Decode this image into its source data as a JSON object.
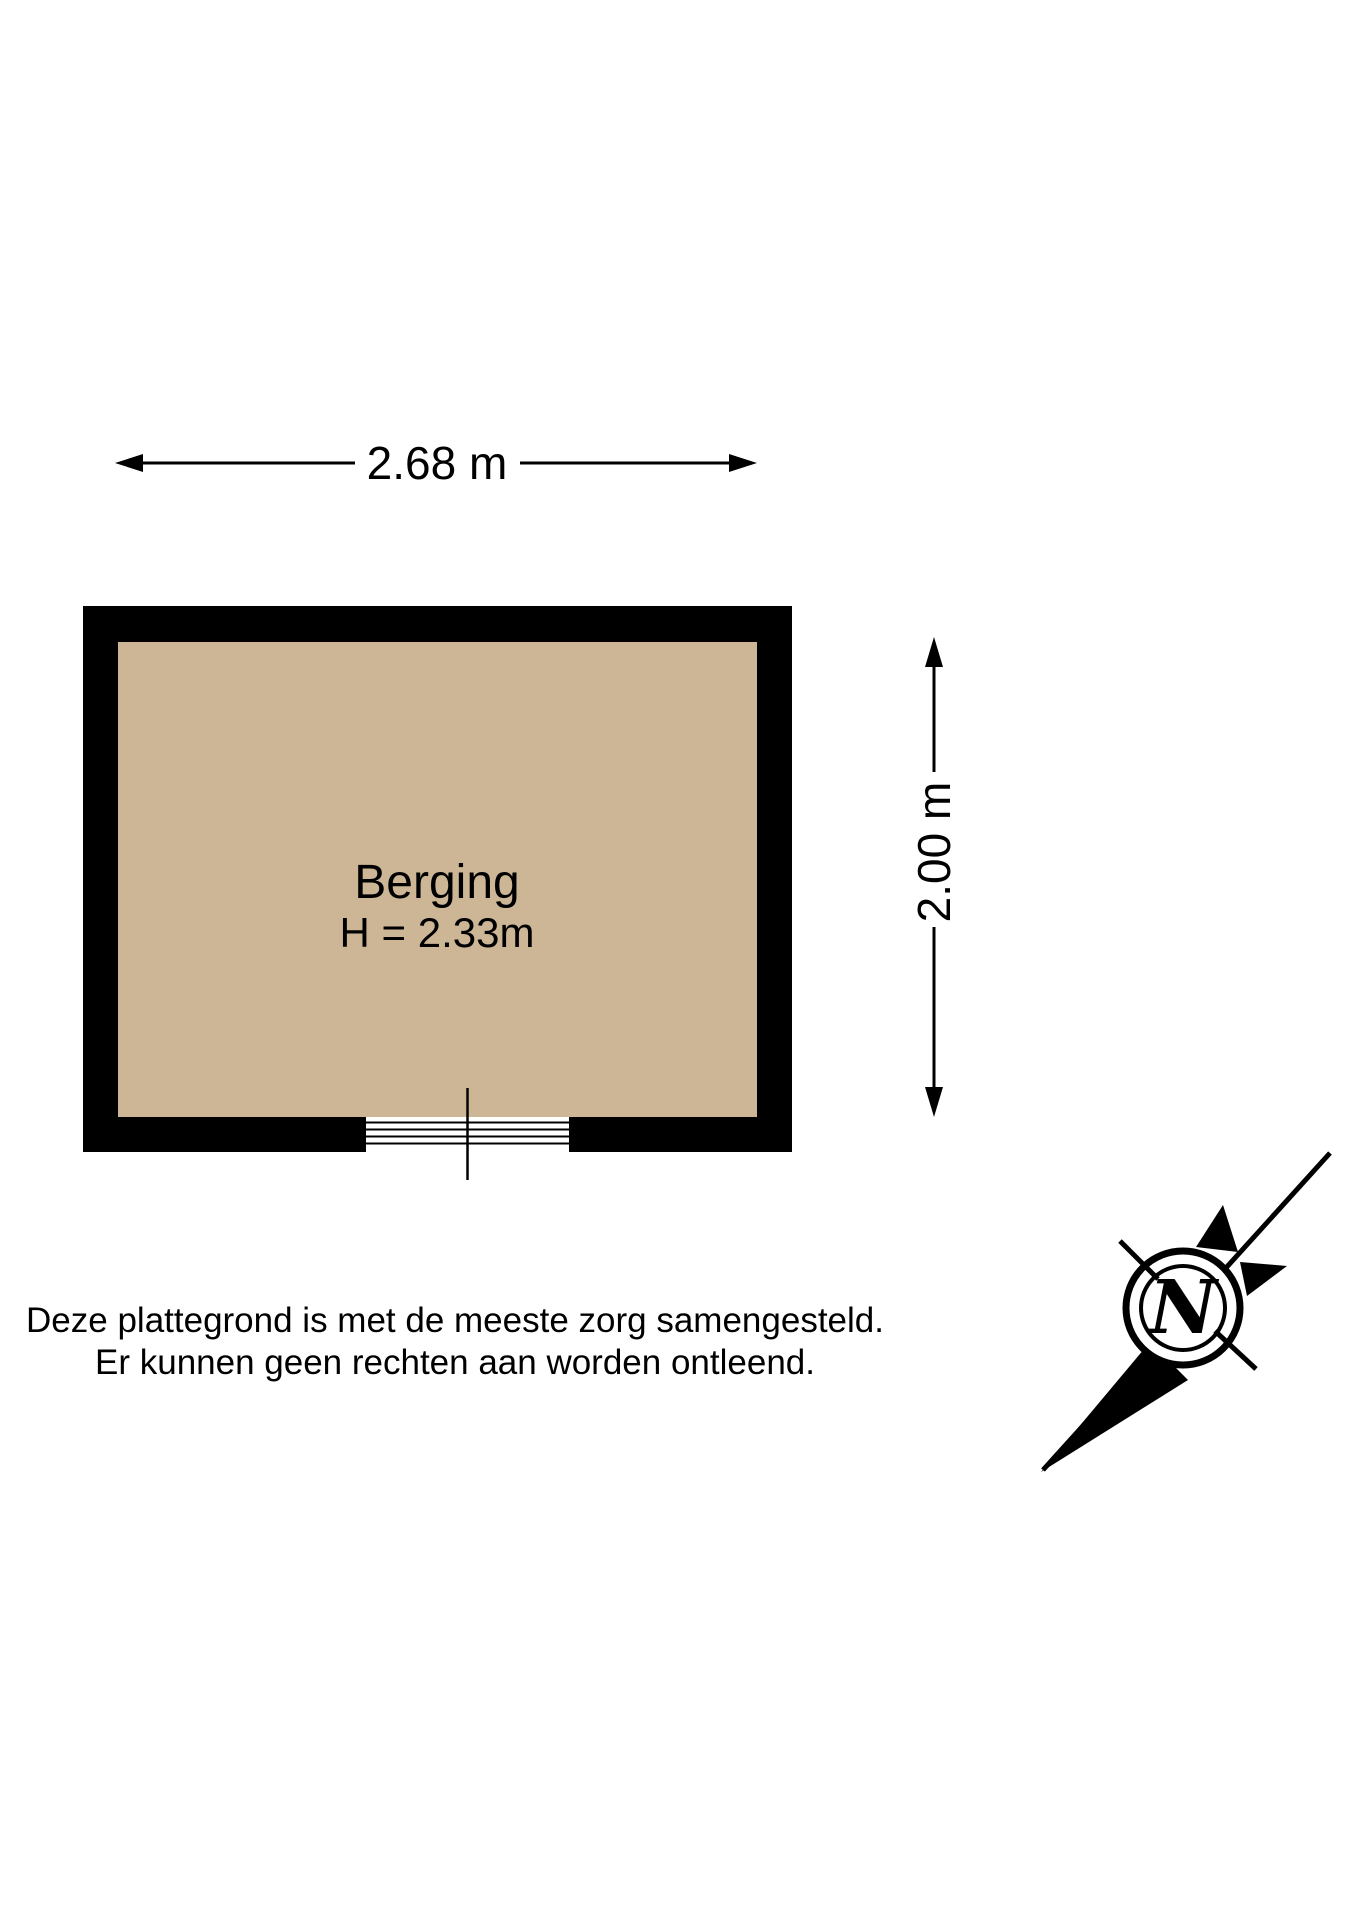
{
  "title": "Plattegrond berging",
  "colors": {
    "background": "#ffffff",
    "wall": "#000000",
    "floor": "#cdb696",
    "ink": "#000000"
  },
  "dimensions": {
    "width_label": "2.68 m",
    "height_label": "2.00 m"
  },
  "room": {
    "name": "Berging",
    "ceiling_height_label": "H = 2.33m"
  },
  "disclaimer": {
    "line1": "Deze plattegrond is met de meeste zorg samengesteld.",
    "line2": "Er kunnen geen rechten aan worden ontleend."
  },
  "compass": {
    "north_label": "N"
  }
}
